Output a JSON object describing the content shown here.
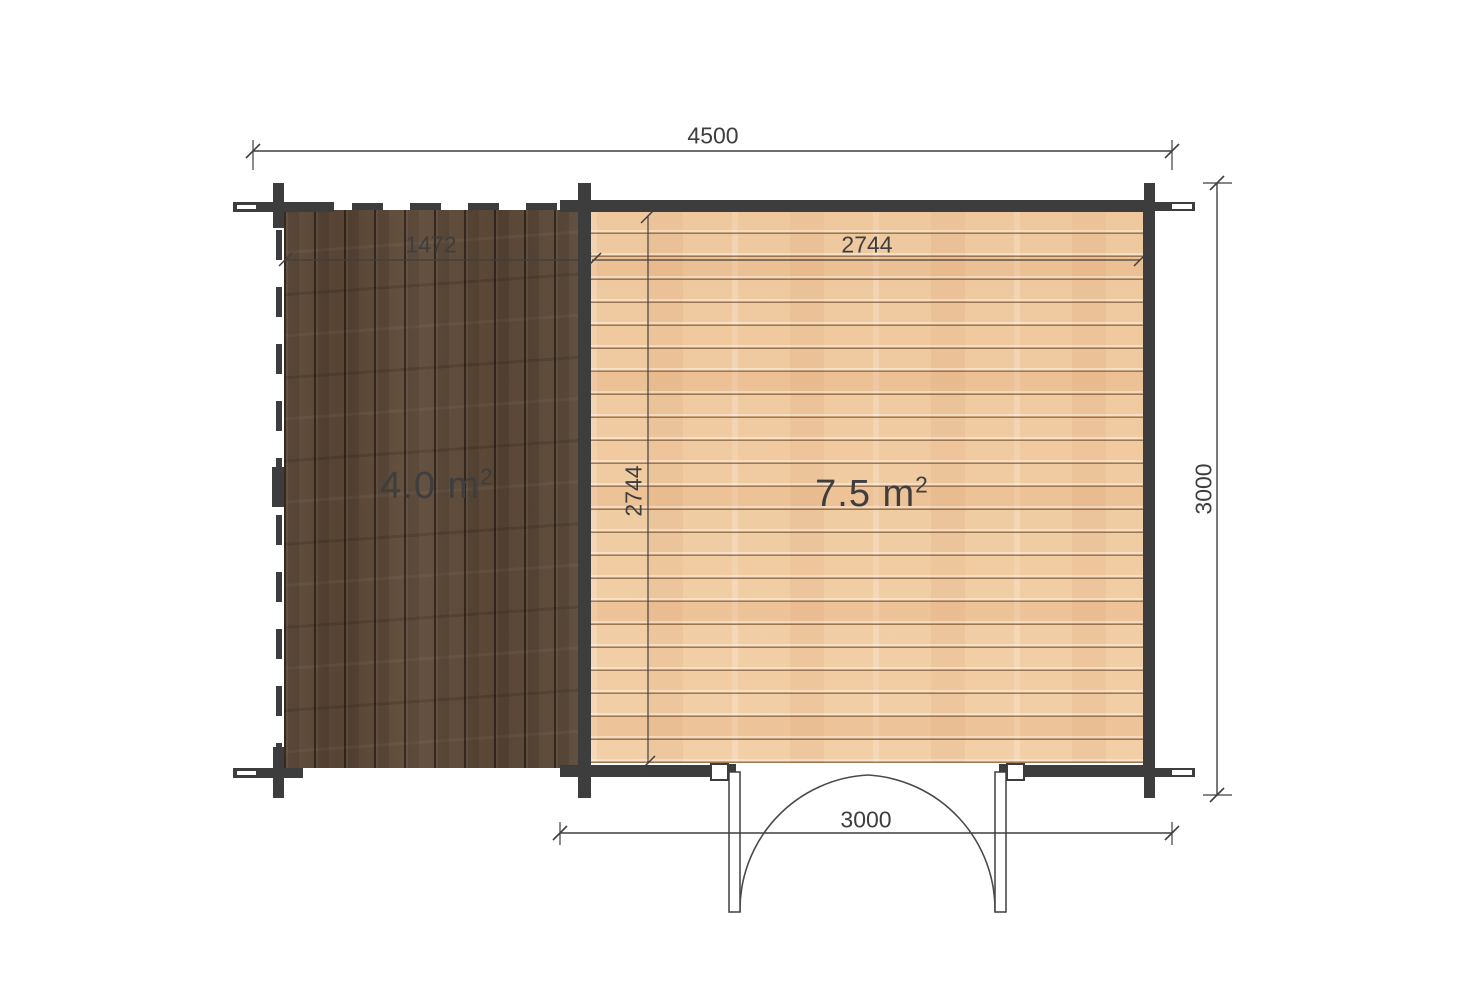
{
  "plan": {
    "dimensions": {
      "overall_width": "4500",
      "terrace_width": "1472",
      "room_width": "2744",
      "room_depth": "2744",
      "overall_depth": "3000",
      "front_width": "3000"
    },
    "areas": {
      "terrace": {
        "text": "4.0 m",
        "sup": "2"
      },
      "room": {
        "text": "7.5 m",
        "sup": "2"
      }
    }
  },
  "colors": {
    "background": "#ffffff",
    "wall": "#3d3d3e",
    "line": "#3f3f3f",
    "text": "#3e3e3e",
    "terrace_wood": "#5e4b3b",
    "room_wood": "#f1cda4",
    "door_outline": "#4a4a4a"
  }
}
